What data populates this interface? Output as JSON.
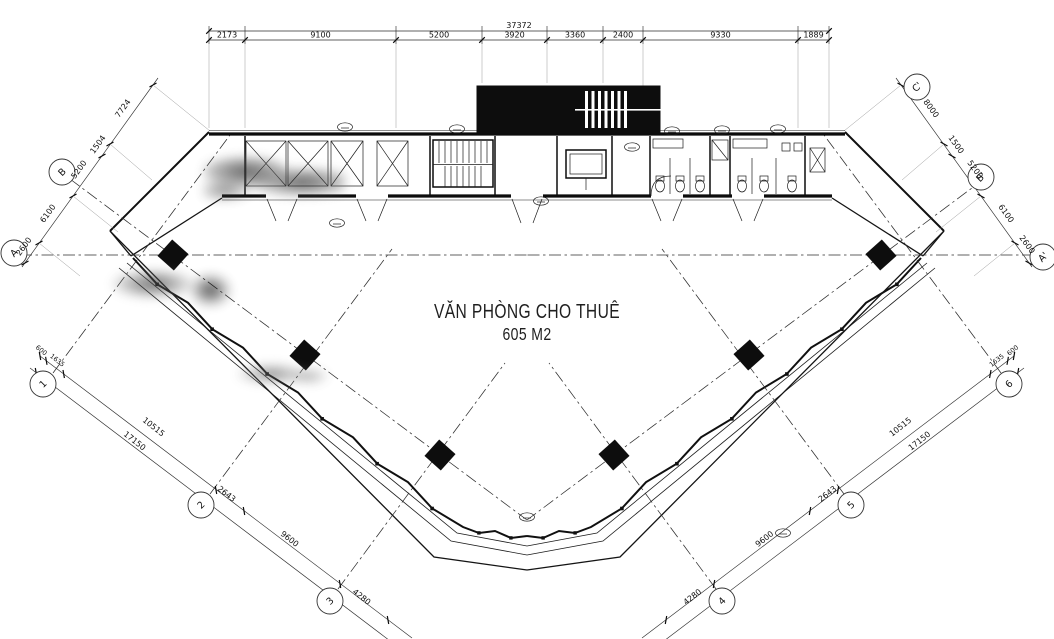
{
  "title": {
    "line1": "VĂN PHÒNG CHO THUÊ",
    "line2": "605 M2"
  },
  "dims": {
    "top_total": "37372",
    "top": [
      "2173",
      "9100",
      "5200",
      "3920",
      "3360",
      "2400",
      "9330",
      "1889"
    ],
    "left_edge": [
      "7724",
      "1504",
      "5200",
      "6100",
      "2600"
    ],
    "right_edge": [
      "8000",
      "1500",
      "5200",
      "6100",
      "2600"
    ],
    "bottom": [
      "600",
      "1635",
      "10515",
      "17150",
      "2643",
      "9600",
      "4280"
    ]
  },
  "grid": {
    "letters_left": [
      "B",
      "A"
    ],
    "letters_right": [
      "C'",
      "B'",
      "A'"
    ],
    "numbers": [
      "1",
      "2",
      "3",
      "4",
      "5",
      "6"
    ]
  },
  "colors": {
    "line": "#1c1c1c",
    "paper": "#ffffff"
  }
}
